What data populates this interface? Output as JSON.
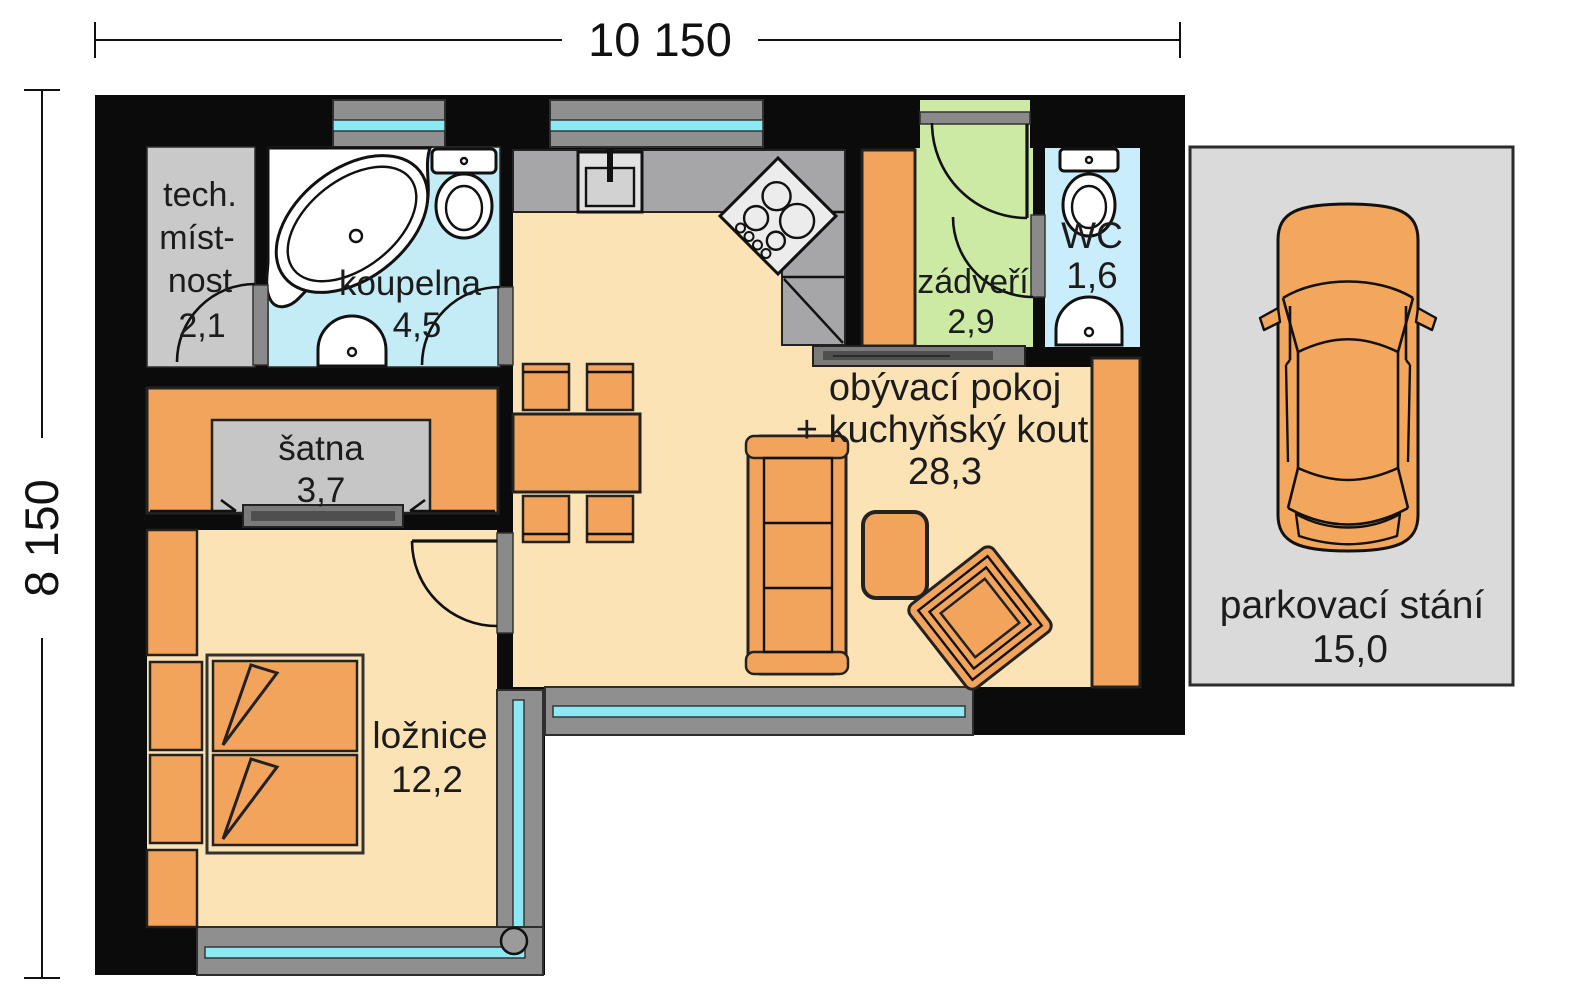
{
  "dimensions": {
    "width_label": "10 150",
    "height_label": "8 150"
  },
  "rooms": {
    "tech_room": {
      "line1": "tech.",
      "line2": "míst-",
      "line3": "nost",
      "area": "2,1"
    },
    "bathroom": {
      "name": "koupelna",
      "area": "4,5"
    },
    "wardrobe": {
      "name": "šatna",
      "area": "3,7"
    },
    "bedroom": {
      "name": "ložnice",
      "area": "12,2"
    },
    "living_room": {
      "line1": "obývací pokoj",
      "line2": "+ kuchyňský kout",
      "area": "28,3"
    },
    "vestibule": {
      "name": "zádveří",
      "area": "2,9"
    },
    "wc": {
      "name": "WC",
      "area": "1,6"
    },
    "parking": {
      "name": "parkovací stání",
      "area": "15,0"
    }
  },
  "colors": {
    "wall": "#0b0b0b",
    "floor": "#fbe3b6",
    "tech_gray": "#c9c9c9",
    "wardrobe_gray": "#c6c6c6",
    "bath_blue": "#c4ecf7",
    "wc_blue": "#c9edfa",
    "entry_green": "#cdeaa5",
    "counter_gray": "#a6a6a8",
    "parking_gray": "#dadada",
    "car_orange": "#f3a75c",
    "furniture_orange": "#f3a45c",
    "glass_cyan": "#8ce8f3"
  }
}
